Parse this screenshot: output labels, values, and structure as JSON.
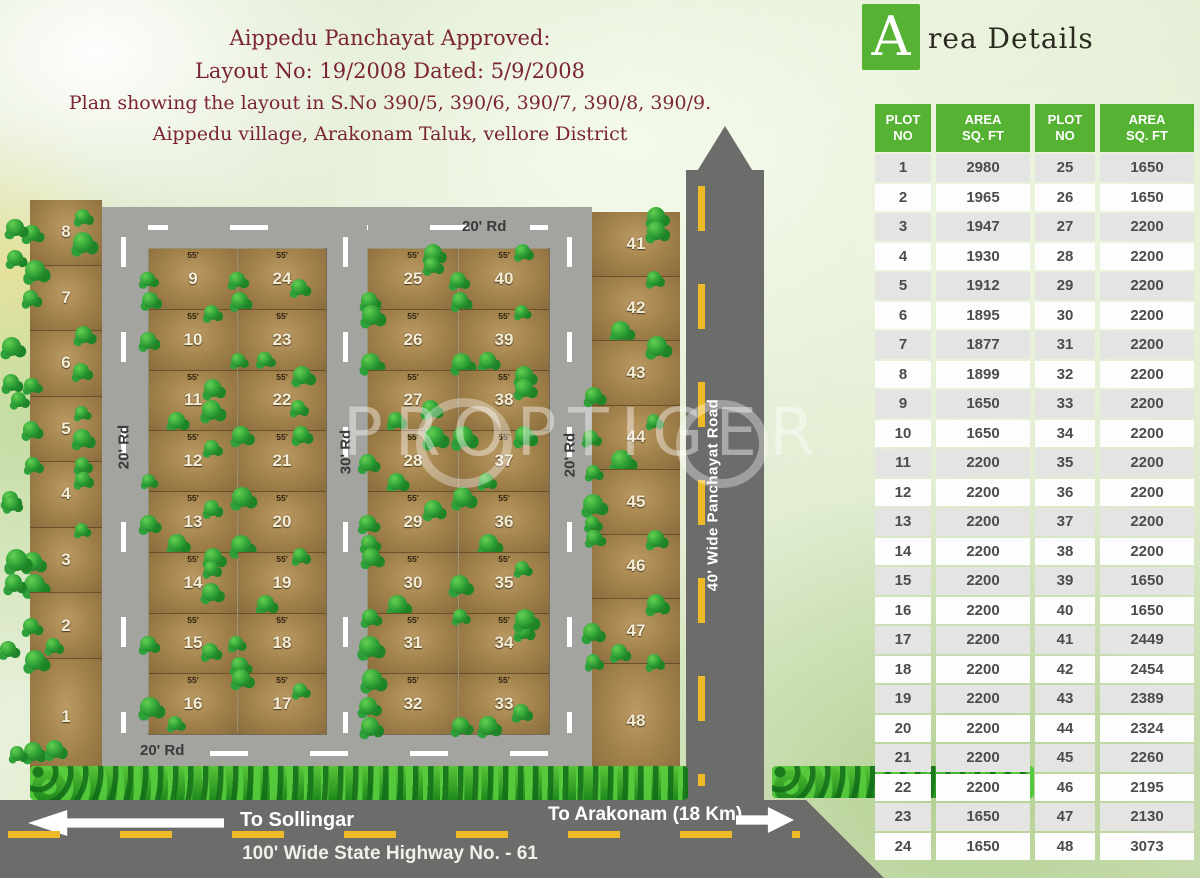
{
  "title_block": {
    "line1": "Aippedu Panchayat Approved:",
    "line2": "Layout No: 19/2008 Dated: 5/9/2008",
    "line3": "Plan showing the layout in S.No 390/5, 390/6, 390/7, 390/8, 390/9.",
    "line4": "Aippedu village, Arakonam Taluk, vellore District"
  },
  "watermark": "PROPTIGER",
  "map": {
    "plot_frontage_label": "55'",
    "left_strip_plots": [
      "8",
      "7",
      "6",
      "5",
      "4",
      "3",
      "2",
      "1"
    ],
    "block_a_left": [
      "9",
      "10",
      "11",
      "12",
      "13",
      "14",
      "15",
      "16"
    ],
    "block_a_right": [
      "24",
      "23",
      "22",
      "21",
      "20",
      "19",
      "18",
      "17"
    ],
    "block_b_left": [
      "25",
      "26",
      "27",
      "28",
      "29",
      "30",
      "31",
      "32"
    ],
    "block_b_right": [
      "40",
      "39",
      "38",
      "37",
      "36",
      "35",
      "34",
      "33"
    ],
    "right_strip_plots": [
      "41",
      "42",
      "43",
      "44",
      "45",
      "46",
      "47",
      "48"
    ],
    "roads": {
      "top_road": "20' Rd",
      "bottom_road": "20' Rd",
      "left_road": "20' Rd",
      "middle_road": "30' Rd",
      "right_road": "20' Rd",
      "panchayat_road": "40' Wide Panchayat Road",
      "highway": "100' Wide State Highway No. - 61"
    },
    "directions": {
      "west": "To Sollingar",
      "east": "To Arakonam (18 Km)"
    }
  },
  "area_details": {
    "logo_letter": "A",
    "title_rest": "rea Details",
    "headers": [
      "PLOT\nNO",
      "AREA\nSQ. FT",
      "PLOT\nNO",
      "AREA\nSQ. FT"
    ],
    "rows": [
      [
        1,
        2980,
        25,
        1650
      ],
      [
        2,
        1965,
        26,
        1650
      ],
      [
        3,
        1947,
        27,
        2200
      ],
      [
        4,
        1930,
        28,
        2200
      ],
      [
        5,
        1912,
        29,
        2200
      ],
      [
        6,
        1895,
        30,
        2200
      ],
      [
        7,
        1877,
        31,
        2200
      ],
      [
        8,
        1899,
        32,
        2200
      ],
      [
        9,
        1650,
        33,
        2200
      ],
      [
        10,
        1650,
        34,
        2200
      ],
      [
        11,
        2200,
        35,
        2200
      ],
      [
        12,
        2200,
        36,
        2200
      ],
      [
        13,
        2200,
        37,
        2200
      ],
      [
        14,
        2200,
        38,
        2200
      ],
      [
        15,
        2200,
        39,
        1650
      ],
      [
        16,
        2200,
        40,
        1650
      ],
      [
        17,
        2200,
        41,
        2449
      ],
      [
        18,
        2200,
        42,
        2454
      ],
      [
        19,
        2200,
        43,
        2389
      ],
      [
        20,
        2200,
        44,
        2324
      ],
      [
        21,
        2200,
        45,
        2260
      ],
      [
        22,
        2200,
        46,
        2195
      ],
      [
        23,
        1650,
        47,
        2130
      ],
      [
        24,
        1650,
        48,
        3073
      ]
    ]
  },
  "colors": {
    "table_header_green": "#55b233",
    "title_maroon": "#7b2433",
    "road_gray": "#a3a3a0",
    "dark_road_gray": "#6c6c6a",
    "dash_yellow": "#eebb28",
    "plot_brown": "#a5854e",
    "tree_green": "#2a9c33"
  }
}
